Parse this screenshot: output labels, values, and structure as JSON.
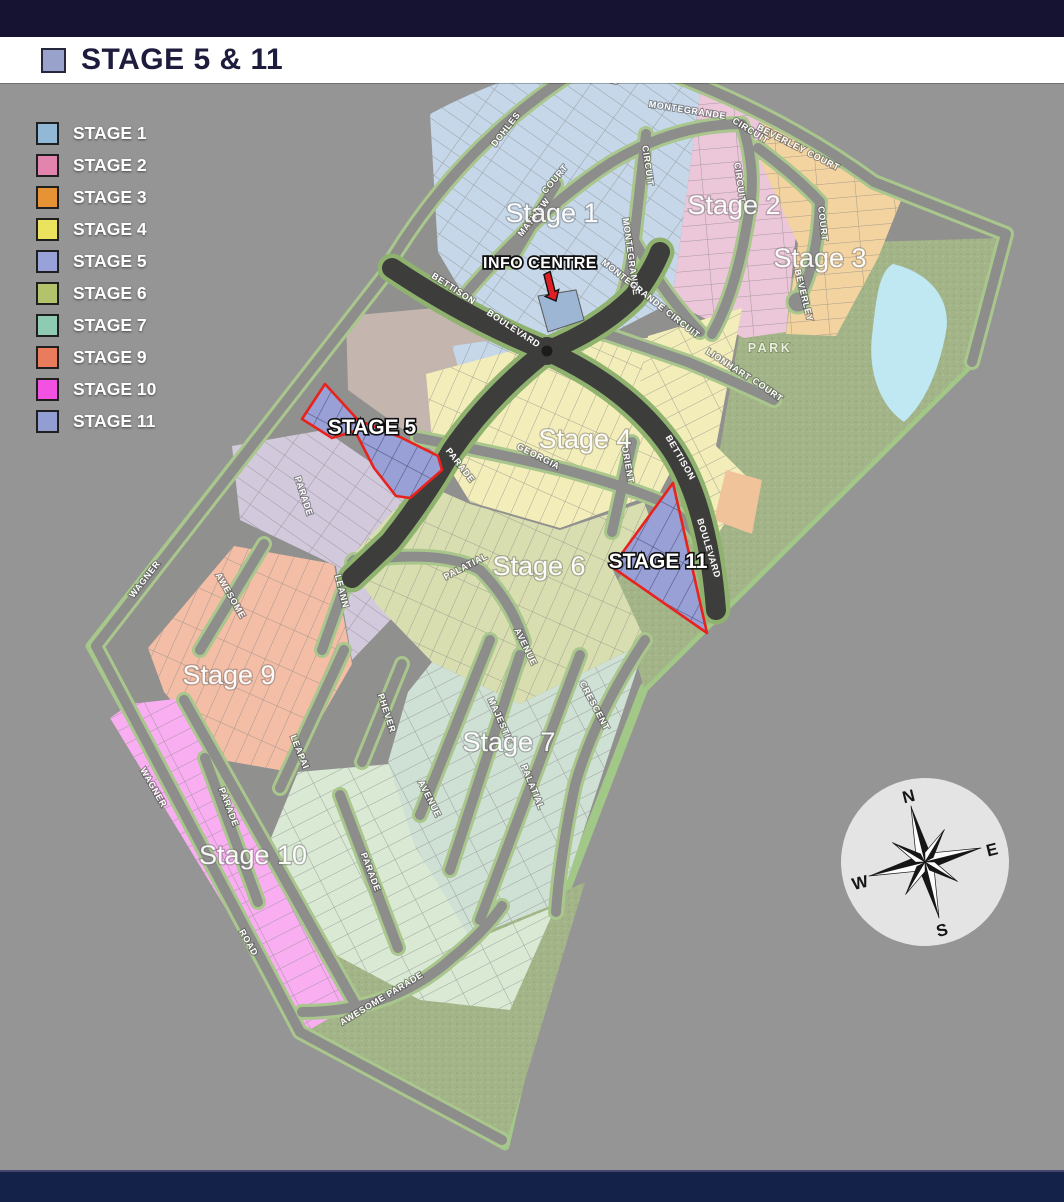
{
  "banner": {
    "title": "STAGE 5 & 11",
    "swatch_color": "#99a2cb"
  },
  "legend": {
    "items": [
      {
        "label": "STAGE 1",
        "color": "#92b8d8"
      },
      {
        "label": "STAGE 2",
        "color": "#e285ae"
      },
      {
        "label": "STAGE 3",
        "color": "#e69335"
      },
      {
        "label": "STAGE 4",
        "color": "#ebe25e"
      },
      {
        "label": "STAGE 5",
        "color": "#98a1d8"
      },
      {
        "label": "STAGE 6",
        "color": "#b2c36c"
      },
      {
        "label": "STAGE 7",
        "color": "#8fcab3"
      },
      {
        "label": "STAGE 9",
        "color": "#e97c5c"
      },
      {
        "label": "STAGE 10",
        "color": "#f251e2"
      },
      {
        "label": "STAGE 11",
        "color": "#929dd1"
      }
    ]
  },
  "map": {
    "labels": [
      {
        "t": "ROCKS",
        "x": 601,
        "y": 79,
        "r": 20,
        "k": "road"
      },
      {
        "t": "DOHLES",
        "x": 508,
        "y": 131,
        "r": -52,
        "k": "road"
      },
      {
        "t": "MONTEGRANDE",
        "x": 687,
        "y": 113,
        "r": 9,
        "k": "road"
      },
      {
        "t": "CIRCUIT",
        "x": 749,
        "y": 133,
        "r": 32,
        "k": "road"
      },
      {
        "t": "CIRCUIT",
        "x": 645,
        "y": 166,
        "r": 82,
        "k": "road"
      },
      {
        "t": "MONTEGRANDE",
        "x": 628,
        "y": 257,
        "r": 82,
        "k": "road"
      },
      {
        "t": "MONTEGRANDE CIRCUIT",
        "x": 649,
        "y": 301,
        "r": 38,
        "k": "road"
      },
      {
        "t": "CIRCUIT",
        "x": 737,
        "y": 183,
        "r": 82,
        "k": "road"
      },
      {
        "t": "BEVERLEY COURT",
        "x": 797,
        "y": 150,
        "r": 27,
        "k": "road"
      },
      {
        "t": "COURT",
        "x": 820,
        "y": 224,
        "r": 84,
        "k": "road"
      },
      {
        "t": "BEVERLEY",
        "x": 801,
        "y": 296,
        "r": 76,
        "k": "road"
      },
      {
        "t": "MATVIEW",
        "x": 536,
        "y": 219,
        "r": -52,
        "k": "road"
      },
      {
        "t": "COURT",
        "x": 557,
        "y": 181,
        "r": -50,
        "k": "road"
      },
      {
        "t": "LIONHART",
        "x": 727,
        "y": 367,
        "r": 33,
        "k": "road"
      },
      {
        "t": "COURT",
        "x": 766,
        "y": 392,
        "r": 35,
        "k": "road"
      },
      {
        "t": "BETTISON",
        "x": 452,
        "y": 291,
        "r": 33,
        "k": "road"
      },
      {
        "t": "BOULEVARD",
        "x": 512,
        "y": 331,
        "r": 33,
        "k": "road"
      },
      {
        "t": "BETTISON",
        "x": 678,
        "y": 459,
        "r": 60,
        "k": "road"
      },
      {
        "t": "BOULEVARD",
        "x": 706,
        "y": 549,
        "r": 73,
        "k": "road"
      },
      {
        "t": "PARADE",
        "x": 458,
        "y": 467,
        "r": 52,
        "k": "road"
      },
      {
        "t": "PARADE",
        "x": 301,
        "y": 497,
        "r": 72,
        "k": "road"
      },
      {
        "t": "GEORGIA",
        "x": 537,
        "y": 459,
        "r": 27,
        "k": "road"
      },
      {
        "t": "ORIENT",
        "x": 625,
        "y": 465,
        "r": 80,
        "k": "road"
      },
      {
        "t": "WAGNER",
        "x": 147,
        "y": 581,
        "r": -52,
        "k": "road"
      },
      {
        "t": "WAGNER",
        "x": 151,
        "y": 789,
        "r": 60,
        "k": "road"
      },
      {
        "t": "ROAD",
        "x": 246,
        "y": 944,
        "r": 60,
        "k": "road"
      },
      {
        "t": "AWESOME",
        "x": 228,
        "y": 597,
        "r": 60,
        "k": "road"
      },
      {
        "t": "LEANN",
        "x": 339,
        "y": 592,
        "r": 76,
        "k": "road"
      },
      {
        "t": "LEAPAI",
        "x": 297,
        "y": 753,
        "r": 68,
        "k": "road"
      },
      {
        "t": "PHEVER",
        "x": 384,
        "y": 714,
        "r": 72,
        "k": "road"
      },
      {
        "t": "MAJESTIC",
        "x": 498,
        "y": 722,
        "r": 66,
        "k": "road"
      },
      {
        "t": "PALATIAL",
        "x": 530,
        "y": 788,
        "r": 68,
        "k": "road"
      },
      {
        "t": "AVENUE",
        "x": 427,
        "y": 800,
        "r": 63,
        "k": "road"
      },
      {
        "t": "AVENUE",
        "x": 523,
        "y": 648,
        "r": 64,
        "k": "road"
      },
      {
        "t": "CRESCENT",
        "x": 592,
        "y": 707,
        "r": 62,
        "k": "road"
      },
      {
        "t": "PALATIAL",
        "x": 467,
        "y": 569,
        "r": -27,
        "k": "road"
      },
      {
        "t": "PARADE",
        "x": 368,
        "y": 873,
        "r": 69,
        "k": "road"
      },
      {
        "t": "PARADE",
        "x": 226,
        "y": 808,
        "r": 69,
        "k": "road"
      },
      {
        "t": "AWESOME PARADE",
        "x": 383,
        "y": 1001,
        "r": -31,
        "k": "road"
      },
      {
        "t": "Stage 1",
        "x": 552,
        "y": 222,
        "r": 0,
        "k": "stage"
      },
      {
        "t": "Stage 2",
        "x": 734,
        "y": 214,
        "r": 0,
        "k": "stage"
      },
      {
        "t": "Stage 3",
        "x": 820,
        "y": 267,
        "r": 0,
        "k": "stage"
      },
      {
        "t": "Stage 4",
        "x": 585,
        "y": 448,
        "r": 0,
        "k": "stage"
      },
      {
        "t": "Stage 6",
        "x": 539,
        "y": 575,
        "r": 0,
        "k": "stage"
      },
      {
        "t": "Stage 7",
        "x": 509,
        "y": 751,
        "r": 0,
        "k": "stage"
      },
      {
        "t": "Stage 9",
        "x": 229,
        "y": 684,
        "r": 0,
        "k": "stage"
      },
      {
        "t": "Stage 10",
        "x": 253,
        "y": 864,
        "r": 0,
        "k": "stage"
      },
      {
        "t": "STAGE 5",
        "x": 372,
        "y": 434,
        "r": 0,
        "k": "hl"
      },
      {
        "t": "STAGE 11",
        "x": 658,
        "y": 568,
        "r": 0,
        "k": "hl"
      },
      {
        "t": "INFO CENTRE",
        "x": 540,
        "y": 268,
        "r": 0,
        "k": "info"
      },
      {
        "t": "PARK",
        "x": 770,
        "y": 352,
        "r": 0,
        "k": "park"
      }
    ],
    "compass": {
      "n": "N",
      "e": "E",
      "s": "S",
      "w": "W"
    }
  },
  "theme": {
    "swatch": "#99a2cb",
    "base": "#90908e",
    "bound": "#a2c887",
    "verge": "#a9c78d",
    "road": "#8d8d8b",
    "vergeD": "#8fb36f",
    "dark": "#3d3d3b",
    "park": "#a3b489",
    "pond": "#bfe8f3",
    "red": "#e8231e",
    "infolot": "#9db6d4",
    "s1": "#c5d7e8",
    "s2": "#ecc6d9",
    "s3": "#f3d3a0",
    "s4": "#f3edb9",
    "s5": "#98a0d6",
    "s6": "#d9deb0",
    "s7": "#cfe0d5",
    "s9": "#f3bda6",
    "s10": "#f8aef1",
    "s11": "#98a0d6",
    "lav": "#d2c9dc",
    "pg": "#d9e9d4",
    "mauve": "#c4b5af",
    "sl": "#f0c39b"
  }
}
